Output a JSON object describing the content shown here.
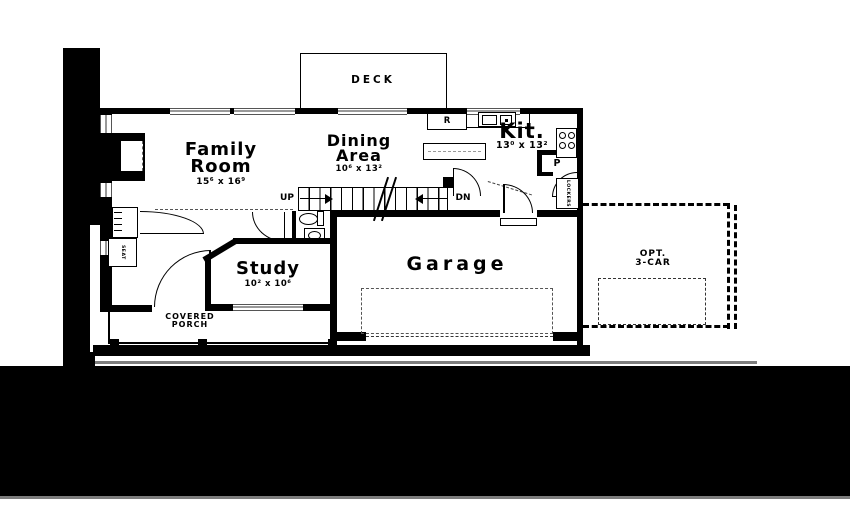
{
  "rooms": {
    "family": {
      "line1": "Family",
      "line2": "Room",
      "dims": "15⁶ x 16⁹"
    },
    "dining": {
      "line1": "Dining",
      "line2": "Area",
      "dims": "10⁶ x 13²"
    },
    "kitchen": {
      "name": "Kit.",
      "dims": "13⁰ x 13²"
    },
    "study": {
      "name": "Study",
      "dims": "10² x 10⁶"
    },
    "garage": {
      "name": "Garage"
    },
    "deck": {
      "name": "DECK"
    },
    "covered_porch": {
      "line1": "COVERED",
      "line2": "PORCH"
    },
    "opt_garage": {
      "line1": "OPT.",
      "line2": "3-CAR"
    }
  },
  "labels": {
    "up": "UP",
    "down": "DN",
    "refrigerator": "R",
    "pantry": "P",
    "lockers": "LOCKERS",
    "seat": "SEAT"
  },
  "colors": {
    "wall": "#000000",
    "window_glass": "#999999",
    "ground_line": "#7d7d7d"
  }
}
